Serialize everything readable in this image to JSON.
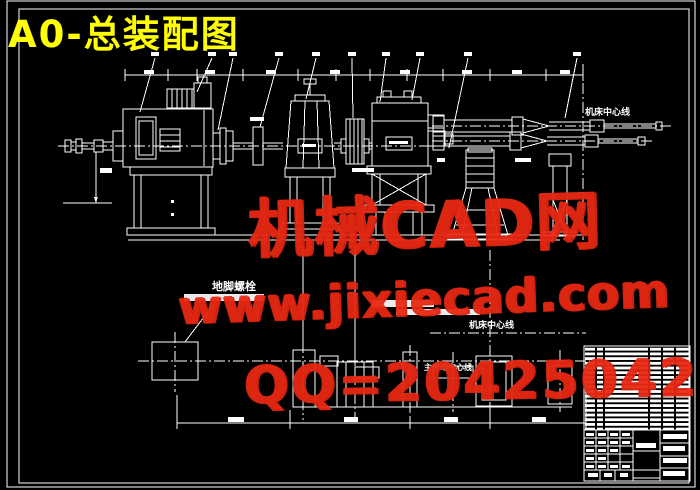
{
  "window": {
    "width": 700,
    "height": 490,
    "background": "#000000"
  },
  "drawing": {
    "title": "A0-总装配图",
    "title_color": "#ffff00",
    "line_color": "#ffffff",
    "labels": {
      "machine_centerline_top": "机床中心线",
      "anchor_bolt": "地脚螺栓",
      "machine_centerline_mid": "机床中心线",
      "main_drive_centerline": "主传动中心线"
    }
  },
  "watermark": {
    "color": "#e82912",
    "brand": "机械CAD网",
    "website": "www.jixiecad.com",
    "qq": "QQ=20425042"
  }
}
